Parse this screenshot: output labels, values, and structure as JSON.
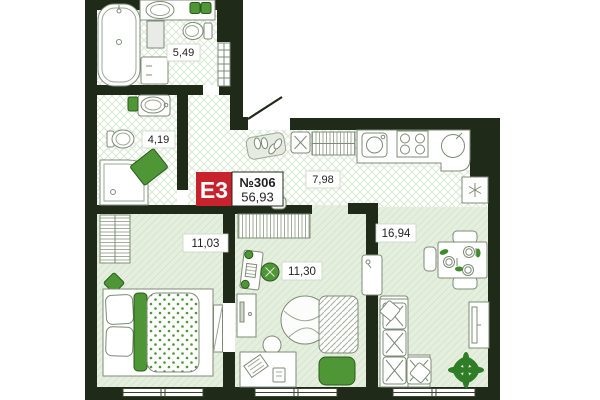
{
  "plan": {
    "badge": {
      "layout_code": "E3",
      "unit_number": "№306",
      "total_area": "56,93"
    },
    "rooms": {
      "bathroom_large": {
        "name": "bathroom-large",
        "area": "5,49"
      },
      "bathroom_small": {
        "name": "bathroom-small",
        "area": "4,19"
      },
      "hallway": {
        "name": "hallway",
        "area": "7,98"
      },
      "bedroom_left": {
        "name": "bedroom-left",
        "area": "11,03"
      },
      "bedroom_middle": {
        "name": "bedroom-middle",
        "area": "11,30"
      },
      "living_kitchen": {
        "name": "living-kitchen",
        "area": "16,94"
      }
    },
    "colors": {
      "wall": "#1f2a19",
      "badge_red": "#c8232c",
      "accent_green": "#4e9636",
      "plant_green": "#2f7d26",
      "floor_tint": "#e6efdf"
    }
  }
}
